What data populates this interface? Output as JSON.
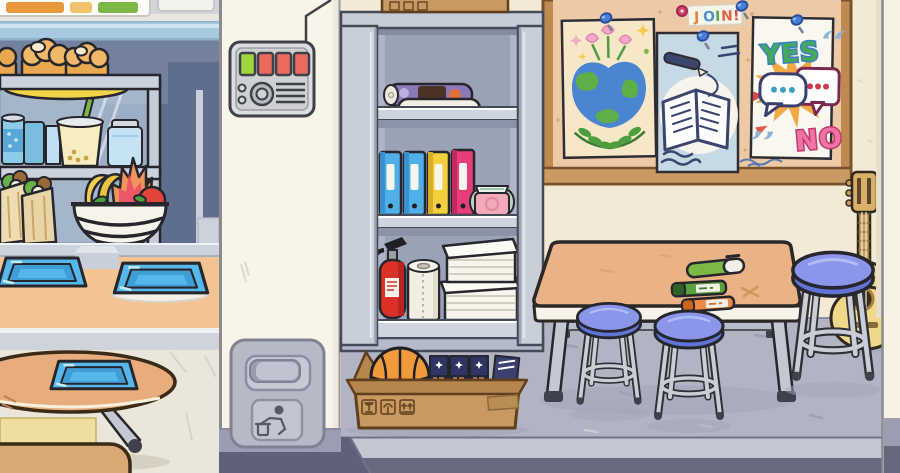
{
  "scene": {
    "name": "toca-style school interior",
    "sections": [
      "cafeteria-counter",
      "hallway-wall",
      "storage-cabinet",
      "classroom"
    ]
  },
  "colors": {
    "left_wall": "#73819f",
    "left_wall_shadow": "#5f6e8e",
    "wall_stripe": "#a6c9e0",
    "cream_wall": "#f8f4e8",
    "classroom_wall": "#f3e9d6",
    "classroom_floor": "#b2b4c4",
    "left_floor": "#eae6da",
    "counter_peach": "#f2c493",
    "tray_blue": "#56b8ea",
    "stool_blue": "#8b96ea",
    "board_cork": "#eec9a6",
    "board_frame": "#c08952",
    "button_green": "#9ed63e",
    "button_red": "#ea6a5e",
    "binder_blue": "#4fb0e8",
    "binder_yellow": "#f4cf3e",
    "binder_pink": "#e53e78",
    "extinguisher_red": "#d93128",
    "basketball_orange": "#f09a3e",
    "cardboard": "#c89a62",
    "guitar_yellow": "#eed98a",
    "table_wood": "#eab287",
    "round_table_wood": "#e8ad7c",
    "yes_fill": "#44a95c",
    "yes_outline": "#3b7fc0",
    "no_fill": "#f073a8",
    "no_outline": "#c23a68",
    "pen_green": "#7cb845",
    "marker_green": "#5ba23e",
    "marker_orange": "#ef8a43",
    "platform_front": "#686a80"
  },
  "icons": {
    "trash_label": "person-dropping-litter-icon",
    "box_symbols": [
      "fragile-goblet-icon",
      "keep-dry-umbrella-icon",
      "this-side-up-arrows-icon"
    ],
    "pins": "blue-push-pin-icon"
  },
  "cafeteria": {
    "menu_signs": 2,
    "cart_items": [
      "bread-loaves-on-plate",
      "soda-cans",
      "bubble-tea-cup",
      "juice-jar",
      "wrap-sandwiches"
    ],
    "fruit_basket_items": [
      "bananas",
      "dragonfruit",
      "apple",
      "leaves"
    ],
    "tray_count": 3
  },
  "hallway": {
    "control_panel": {
      "buttons": [
        {
          "color": "#9ed63e"
        },
        {
          "color": "#ea6a5e"
        },
        {
          "color": "#ea6a5e"
        },
        {
          "color": "#ea6a5e"
        }
      ],
      "indicator_dots": 2,
      "knob": 1,
      "vent_lines": 4
    },
    "trash_can": {
      "icon": "person-dropping-litter-icon"
    }
  },
  "storage": {
    "cabinet_shelves": [
      [
        "rolled-posters"
      ],
      [
        "binder",
        "binder",
        "binder",
        "binder",
        "folded-shirt"
      ],
      [
        "fire-extinguisher",
        "paper-towel-roll",
        "paper-stacks"
      ]
    ],
    "binder_colors": [
      "#4fb0e8",
      "#4fb0e8",
      "#f4cf3e",
      "#e53e78"
    ],
    "box_on_top_symbols": 3,
    "floor_box": {
      "contents": [
        "basketball",
        "star-books"
      ],
      "tape": true
    }
  },
  "classroom": {
    "bulletin_board": {
      "join_sign": {
        "letters": [
          {
            "char": "J",
            "color": "#e0853c"
          },
          {
            "char": "O",
            "color": "#4e8fd2"
          },
          {
            "char": "I",
            "color": "#58a74e"
          },
          {
            "char": "N",
            "color": "#e06540"
          },
          {
            "char": "!",
            "color": "#d84a52"
          }
        ]
      },
      "posters": [
        {
          "name": "earth-flowers-poster"
        },
        {
          "name": "open-book-pen-poster"
        },
        {
          "name": "yes-no-poster",
          "yes_label": "YES",
          "no_label": "NO"
        }
      ],
      "pin_count": 4
    },
    "table_items": [
      "green-pen",
      "green-marker",
      "orange-marker"
    ],
    "stool_count": 3,
    "guitar": true
  }
}
